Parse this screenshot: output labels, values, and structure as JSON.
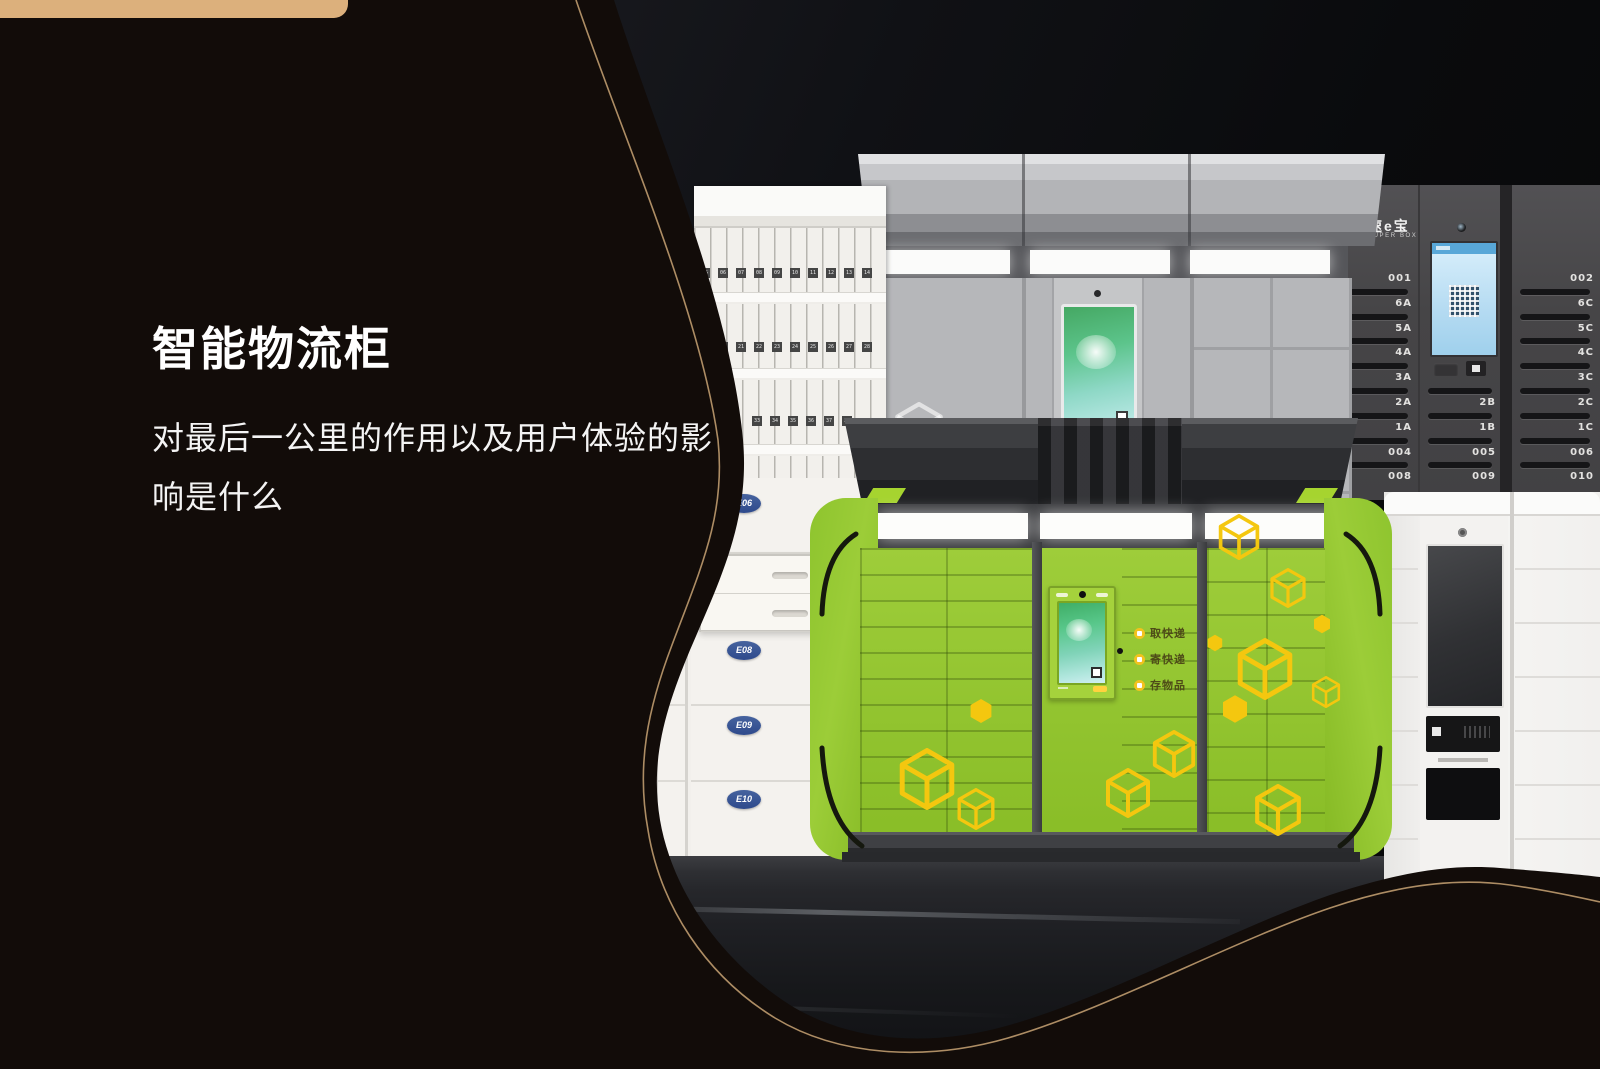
{
  "page": {
    "title": "智能物流柜",
    "subtitle_line1": "对最后一公里的作用以及用户体验的影",
    "subtitle_line2": "响是什么"
  },
  "superbox": {
    "brand": {
      "cn": "速e宝",
      "en": "SUPER BOX"
    },
    "col_a": [
      "001",
      "6A",
      "5A",
      "4A",
      "3A",
      "2A",
      "1A",
      "004",
      "008"
    ],
    "col_b": [
      "2B",
      "1B",
      "005",
      "009"
    ],
    "col_c": [
      "002",
      "6C",
      "5C",
      "4C",
      "3C",
      "2C",
      "1C",
      "006",
      "010"
    ]
  },
  "green_locker": {
    "menu": [
      "取快递",
      "寄快递",
      "存物品"
    ]
  },
  "white_locker": {
    "badges": [
      "E06",
      "E08",
      "E09",
      "E10"
    ]
  },
  "letterbox": {
    "rows": [
      [
        "05",
        "06",
        "07",
        "08",
        "09",
        "10",
        "11",
        "12",
        "13",
        "14"
      ],
      [
        "19",
        "20",
        "21",
        "22",
        "23",
        "24",
        "25",
        "26",
        "27",
        "28"
      ],
      [
        "33",
        "34",
        "35",
        "36",
        "37",
        "38"
      ]
    ]
  },
  "colors": {
    "accent_green": "#94c52f",
    "decal_yellow": "#f4c70f",
    "gold_line": "#bf9b6f",
    "tan_bar": "#dcb07c",
    "badge_blue": "#2e4a8c",
    "background_black": "#120c09"
  }
}
